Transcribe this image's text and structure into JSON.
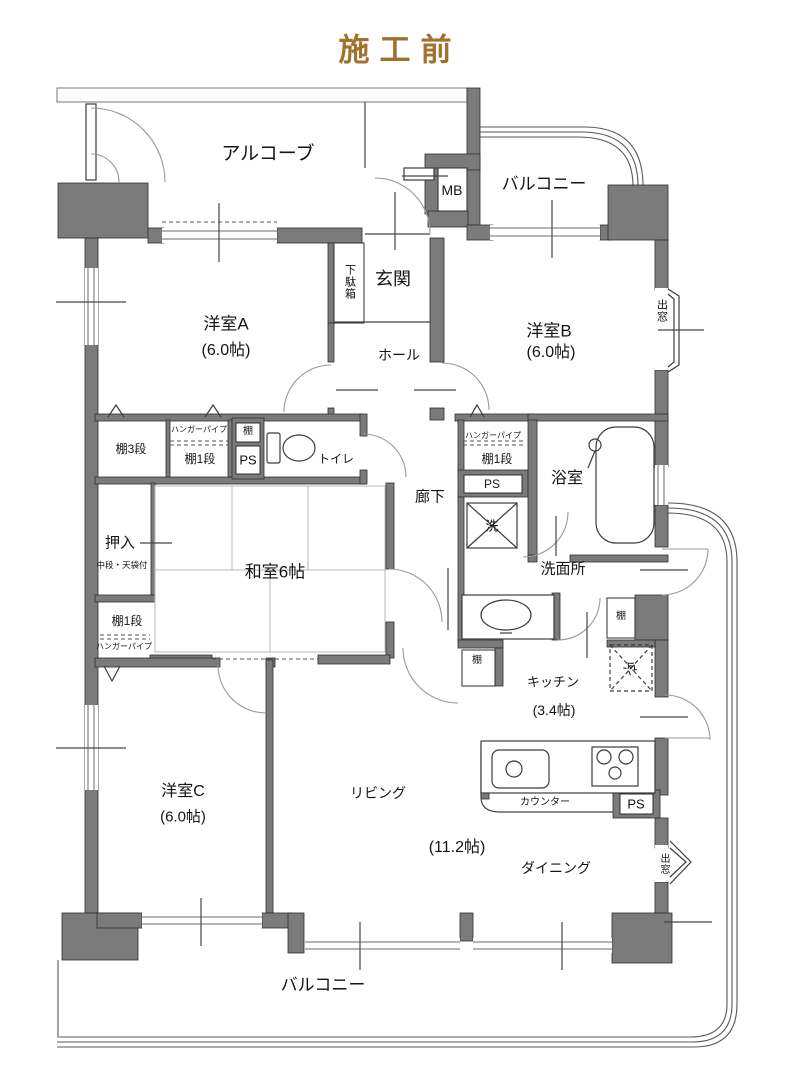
{
  "title": "施工前",
  "colors": {
    "wall": "#7b7b7b",
    "line": "#333333",
    "title": "#a2722c",
    "arc": "#999999",
    "tatami": "#b9b9b9",
    "dash": "#555555"
  },
  "labels": {
    "alcove": "アルコーブ",
    "balcony": "バルコニー",
    "mb": "MB",
    "entrance": "玄関",
    "shoe_box": "下駄箱",
    "hall": "ホール",
    "room_a": "洋室A",
    "room_b": "洋室B",
    "room_c": "洋室C",
    "size_6": "(6.0帖)",
    "bay_window": "出窓",
    "shelf_3": "棚3段",
    "hanger_pipe": "ハンガーパイプ",
    "shelf_1": "棚1段",
    "shelf": "棚",
    "ps": "PS",
    "toilet": "トイレ",
    "corridor": "廊下",
    "wash": "洗",
    "bathroom": "浴室",
    "closet": "押入",
    "closet_note": "中段・天袋付",
    "japanese_room": "和室6帖",
    "washroom": "洗面所",
    "fridge": "冷",
    "kitchen": "キッチン",
    "kitchen_size": "(3.4帖)",
    "living": "リビング",
    "ld_size": "(11.2帖)",
    "dining": "ダイニング",
    "counter": "カウンター"
  }
}
